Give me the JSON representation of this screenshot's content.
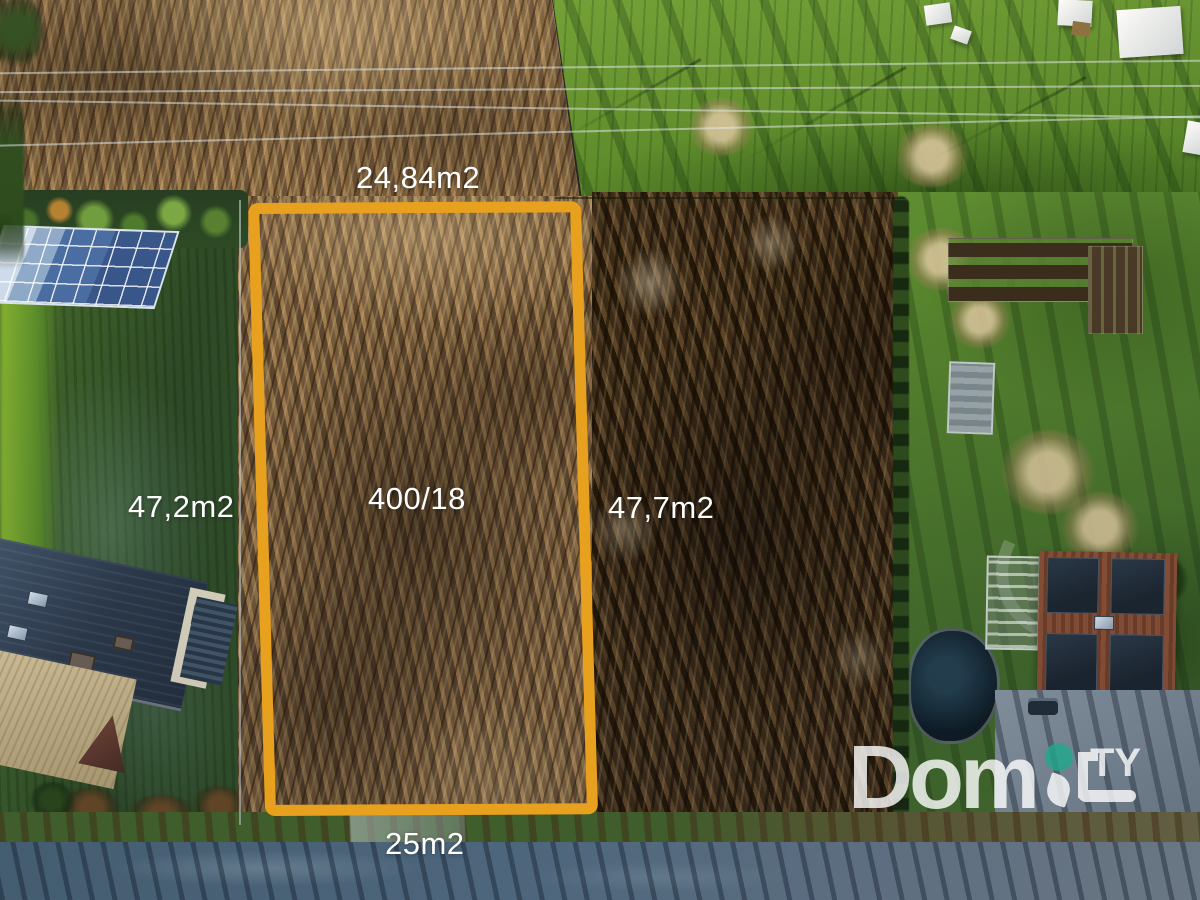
{
  "annotation": {
    "outline_color": "#E8A11E",
    "labels": {
      "top": "24,84m2",
      "left": "47,2m2",
      "parcel": "400/18",
      "right": "47,7m2",
      "bottom": "25m2"
    }
  },
  "watermark": {
    "dom": "Dom",
    "ty": "TY",
    "dot_color": "#1FA98C"
  },
  "scene": {
    "type": "aerial-drone-photo",
    "features": [
      "dry-reed-field",
      "green-meadow",
      "brush-woodland",
      "house-dark-roof",
      "solar-panel-array",
      "vegetable-garden",
      "greenhouse",
      "house-rooftop-solar",
      "pond",
      "gravel-driveway",
      "asphalt-road",
      "power-lines"
    ]
  }
}
